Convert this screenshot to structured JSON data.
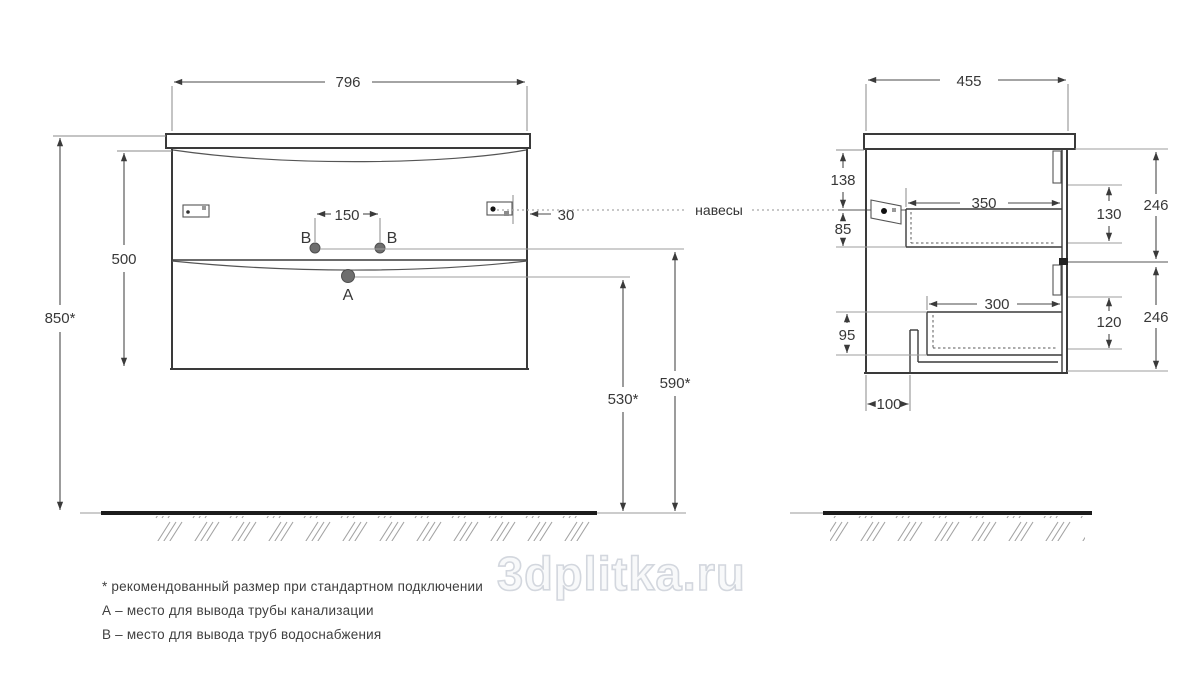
{
  "drawing": {
    "hangers_label": "навесы",
    "watermark": "3dplitka.ru",
    "front": {
      "width": "796",
      "cabinet_height": "500",
      "mount_height": "850*",
      "hole_spacing": "150",
      "hanger_inset": "30",
      "water_outlet_height": "590*",
      "drain_outlet_height": "530*",
      "point_a": "A",
      "point_b": "B"
    },
    "side": {
      "depth": "455",
      "top_to_hanger": "138",
      "hanger_to_box": "85",
      "drawer1_inner_depth": "350",
      "drawer1_inner_height": "130",
      "front_height_top": "246",
      "drawer2_inner_depth": "300",
      "drawer2_inner_height": "120",
      "front_height_bottom": "246",
      "bottom_clearance": "95",
      "pipe_offset": "100"
    },
    "notes": {
      "asterisk": "* рекомендованный размер при стандартном подключении",
      "a": "А – место для вывода трубы канализации",
      "b": "В – место для вывода труб водоснабжения"
    }
  }
}
